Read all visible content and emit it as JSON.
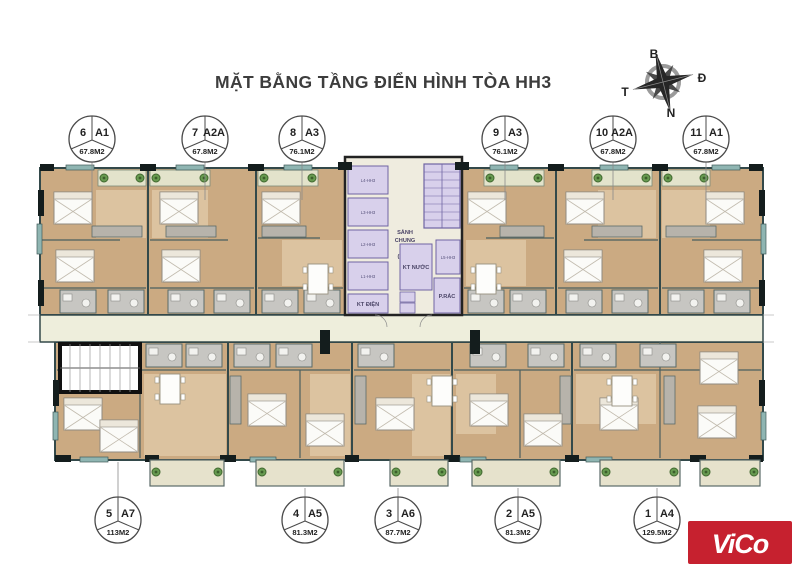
{
  "title": "MẶT BẰNG TẦNG ĐIỂN HÌNH TÒA HH3",
  "compass": {
    "north": "B",
    "east": "Đ",
    "west": "T",
    "south": "N"
  },
  "units_top": [
    {
      "num": "6",
      "type": "A1",
      "area": "67.8M2"
    },
    {
      "num": "7",
      "type": "A2A",
      "area": "67.8M2"
    },
    {
      "num": "8",
      "type": "A3",
      "area": "76.1M2"
    },
    {
      "num": "9",
      "type": "A3",
      "area": "76.1M2"
    },
    {
      "num": "10",
      "type": "A2A",
      "area": "67.8M2"
    },
    {
      "num": "11",
      "type": "A1",
      "area": "67.8M2"
    }
  ],
  "units_bottom": [
    {
      "num": "5",
      "type": "A7",
      "area": "113M2"
    },
    {
      "num": "4",
      "type": "A5",
      "area": "81.3M2"
    },
    {
      "num": "3",
      "type": "A6",
      "area": "87.7M2"
    },
    {
      "num": "2",
      "type": "A5",
      "area": "81.3M2"
    },
    {
      "num": "1",
      "type": "A4",
      "area": "129.5M2"
    }
  ],
  "core": {
    "lobby_line1": "SẢNH",
    "lobby_line2": "CHUNG",
    "lobby_line3": "CƯ",
    "lobby_line4": "(HH3)",
    "kt_nuoc": "KT NƯỚC",
    "p_rac": "P.RÁC",
    "kt_dien": "KT ĐIỆN",
    "elevators": [
      "L4-HH3",
      "L3-HH3",
      "L2-HH3",
      "L1-HH3",
      "L5-HH3"
    ]
  },
  "logo": {
    "text": "ViCo",
    "bg_color": "#c6212f"
  },
  "colors": {
    "wood": "#cbaa82",
    "wood_light": "#dcc3a0",
    "corridor": "#eeeedc",
    "lavender": "#d8d0eb",
    "wall": "#33494a",
    "balcony": "#e6e2cc"
  }
}
